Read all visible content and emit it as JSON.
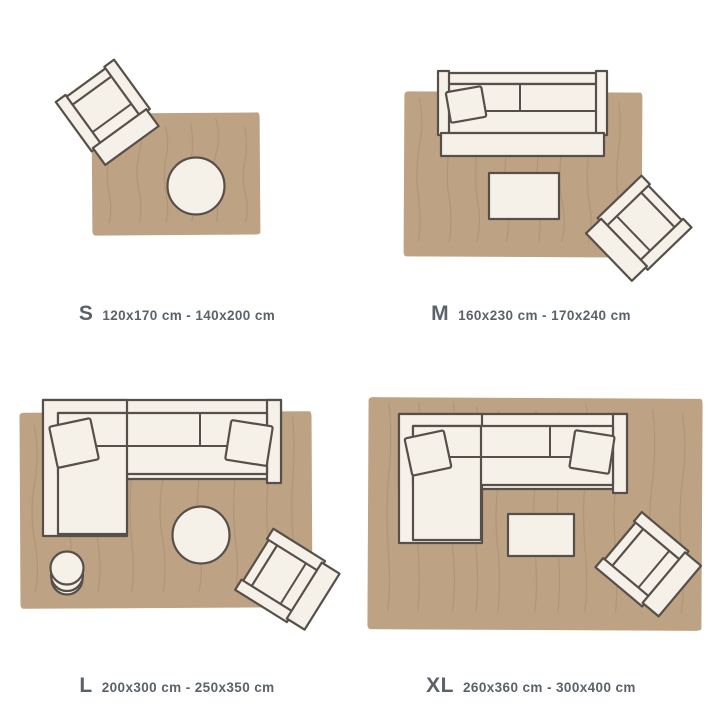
{
  "colors": {
    "background": "#ffffff",
    "rug": "#bda284",
    "rugLine": "#a78d6e",
    "furniture": "#f5f1e9",
    "outline": "#57504a",
    "text": "#5b6269"
  },
  "sizes": [
    {
      "id": "s",
      "label": "S",
      "range": "120x170 cm - 140x200 cm"
    },
    {
      "id": "m",
      "label": "M",
      "range": "160x230 cm - 170x240 cm"
    },
    {
      "id": "l",
      "label": "L",
      "range": "200x300 cm - 250x350 cm"
    },
    {
      "id": "xl",
      "label": "XL",
      "range": "260x360 cm - 300x400 cm"
    }
  ]
}
